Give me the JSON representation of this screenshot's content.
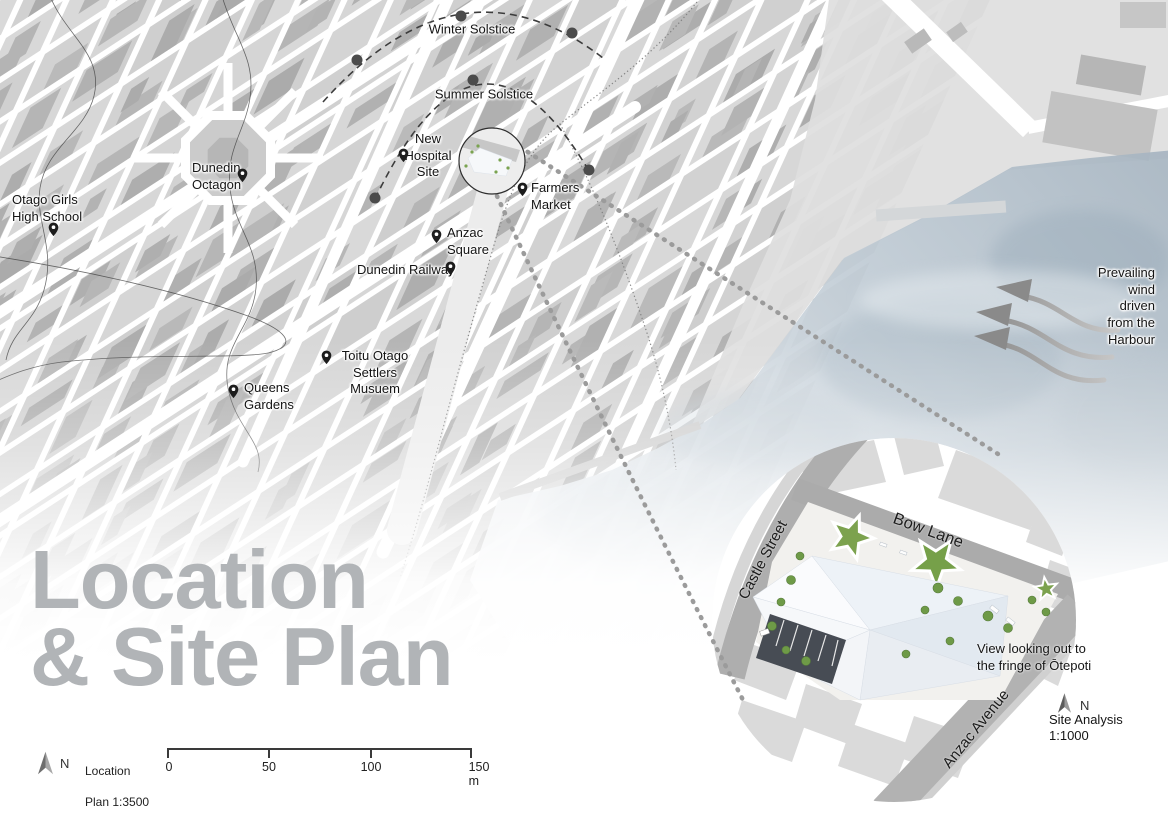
{
  "title": {
    "line1": "Location",
    "line2": "& Site Plan"
  },
  "map": {
    "labels": {
      "winter": "Winter Solstice",
      "summer": "Summer Solstice",
      "hospital": "New\nHospital\nSite",
      "octagon": "Dunedin\nOctagon",
      "otago_girls": "Otago Girls\nHigh School",
      "farmers": "Farmers\nMarket",
      "anzac_square": "Anzac\nSquare",
      "railway": "Dunedin Railway",
      "toitu": "Toitu Otago\nSettlers Musuem",
      "queens": "Queens\nGardens",
      "wind_note": "Prevailing wind driven\nfrom the Harbour"
    }
  },
  "inset": {
    "castle_street": "Castle Street",
    "bow_lane": "Bow Lane",
    "anzac_avenue": "Anzac Avenue",
    "view_note": "View looking out to\nthe fringe of Ōtepoti",
    "north_label": "N",
    "analysis_title": "Site Analysis",
    "analysis_scale": "1:1000"
  },
  "legend": {
    "north_label": "N",
    "plan_name": "Location",
    "plan_scale": "Plan 1:3500",
    "scalebar_ticks": [
      "0",
      "50",
      "100",
      "150 m"
    ]
  },
  "icons": {
    "map_pin": "map-pin balloon with white dot",
    "north_arrow": "split triangle, dark left / light right",
    "wind_arrow": "s-curved arrow pointing upper-left",
    "solstice_dot": "dark filled circle on dashed arc"
  },
  "colors": {
    "block": "#d6d6d6",
    "building": "#b4b4b4",
    "road_dark": "#ababab",
    "water": "#aebbc6",
    "title_gray": "#b1b4b7",
    "site_green": "#76a049",
    "pin_black": "#1d1d1d"
  }
}
